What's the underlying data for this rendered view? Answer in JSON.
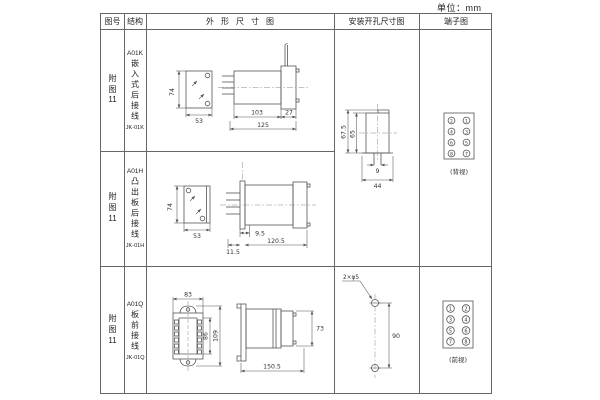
{
  "unit_label": "单位：mm",
  "header": {
    "figure": "图号",
    "structure": "结构",
    "outline": "外形尺寸图",
    "mounting": "安装开孔尺寸图",
    "terminal": "端子图"
  },
  "rows": [
    {
      "figure": [
        "附",
        "图",
        "11"
      ],
      "model": "A01K",
      "structure_chars": "嵌入式后接线",
      "code": "JK-01K",
      "dims": {
        "height": "74",
        "width": "53",
        "body": "103",
        "flange": "27",
        "total": "125"
      }
    },
    {
      "figure": [
        "附",
        "图",
        "11"
      ],
      "model": "A01H",
      "structure_chars": "凸出板后接线",
      "code": "JK-01H",
      "dims": {
        "height": "74",
        "width": "53",
        "d1": "9.5",
        "d2": "11.5",
        "d3": "120.5"
      }
    },
    {
      "figure": [
        "附",
        "图",
        "11"
      ],
      "model": "A01Q",
      "structure_chars": "板前接线",
      "code": "JK-01Q",
      "dims": {
        "top_width": "83",
        "inner_height": "86",
        "outer_height": "109",
        "side_height": "73",
        "side_length": "150.5"
      }
    }
  ],
  "mounting_rear": {
    "outer_h": "67.5",
    "inner_h": "65",
    "slot_w": "9",
    "total_w": "44"
  },
  "mounting_front": {
    "holes": "2×φ5",
    "distance": "90"
  },
  "terminal_rear": {
    "grid": [
      [
        "2",
        "1"
      ],
      [
        "4",
        "3"
      ],
      [
        "6",
        "5"
      ],
      [
        "8",
        "7"
      ]
    ],
    "caption": "(背视)"
  },
  "terminal_front": {
    "grid": [
      [
        "1",
        "2"
      ],
      [
        "3",
        "4"
      ],
      [
        "5",
        "6"
      ],
      [
        "7",
        "8"
      ]
    ],
    "caption": "(前视)"
  }
}
